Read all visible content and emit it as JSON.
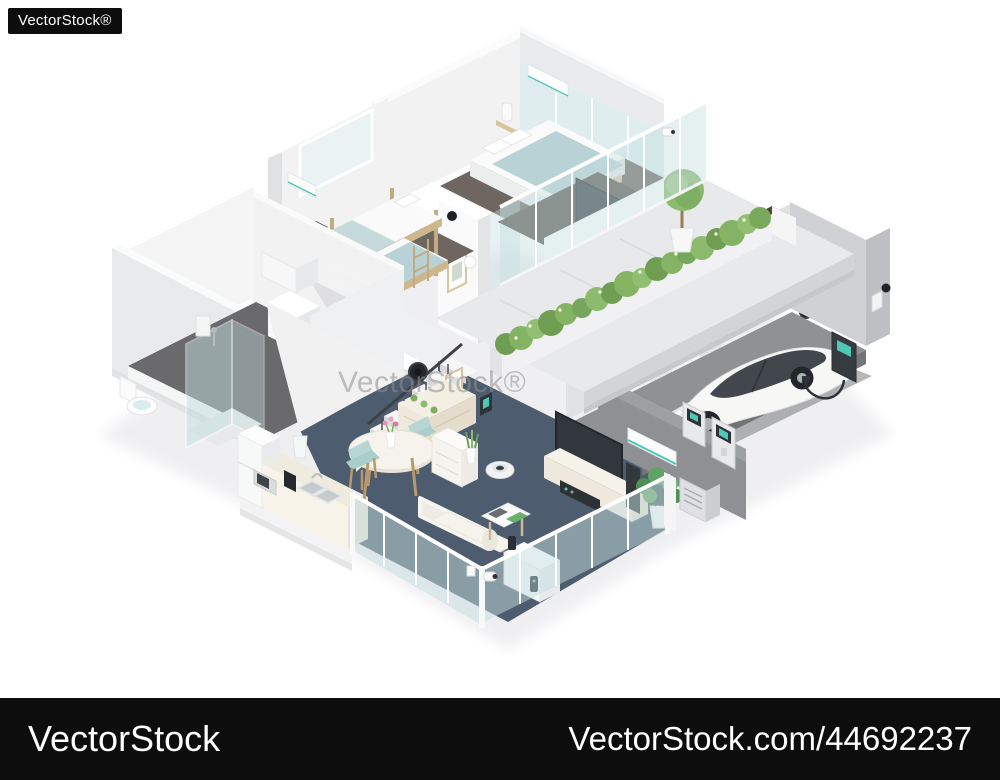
{
  "watermarks": {
    "logo": "VectorStock®",
    "center": "VectorStock®",
    "bar_left": "VectorStock",
    "bar_right": "VectorStock.com/44692237"
  },
  "illustration": {
    "alt": "Isometric cutaway illustration of a two-story smart home: kids bedroom with bunk bed, master bedroom, roof-garden hedge terrace with topiary tree and outdoor TV counter upstairs; living room with dining set, kitchen, stairs, sofa, media wall, bathroom with shower and laundry, and an EV garage with white electric car, wall charger and battery panels downstairs; glass walls with security cameras and smart devices",
    "palette": {
      "background": "#ffffff",
      "watermark-bar": "#0d0d0d",
      "watermark-text": "#ffffff",
      "watermark-center": "#8f8f8f",
      "wall-white": "#f2f2f3",
      "wall-light": "#e9eaeb",
      "wall-shade": "#d8d9db",
      "wall-gray": "#8e9093",
      "floor-living": "#4d5c6e",
      "floor-carpet": "#6f6662",
      "floor-bath": "#6a6a6d",
      "floor-garage": "#8f9193",
      "terrace": "#e7e9ea",
      "glass": "#c5dee0",
      "hedge": "#83b363",
      "hedge-dark": "#6f9e52",
      "soil": "#4e4637",
      "wood": "#d8c49c",
      "teal": "#4ec9b6",
      "device-dark": "#3d4247",
      "cream": "#efe9dd",
      "car-white": "#f7f7f6",
      "car-glass": "#42474d",
      "bed-blue": "#b9d2d5"
    }
  }
}
